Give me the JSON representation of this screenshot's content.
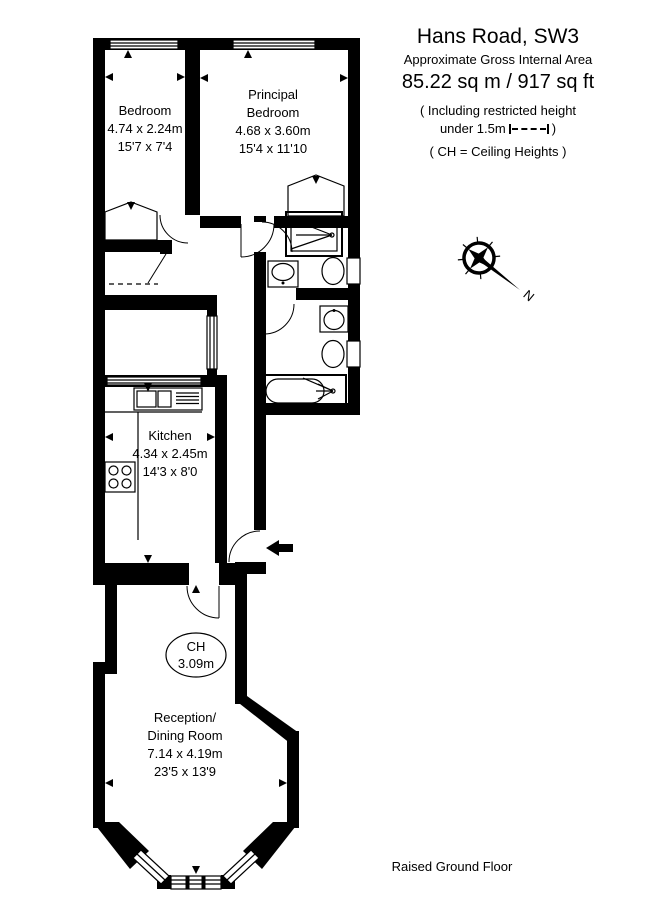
{
  "header": {
    "title": "Hans Road, SW3",
    "subtitle": "Approximate Gross Internal Area",
    "area": "85.22 sq m  /  917 sq ft",
    "note1": "( Including restricted height",
    "note2_pre": "under 1.5m",
    "note2_post": ")",
    "note3": "( CH = Ceiling Heights )"
  },
  "footer": {
    "label": "Raised Ground Floor"
  },
  "compass": {
    "north": "N"
  },
  "rooms": {
    "bedroom": {
      "name": "Bedroom",
      "metric": "4.74 x 2.24m",
      "imperial": "15'7 x 7'4"
    },
    "principal": {
      "line1": "Principal",
      "line2": "Bedroom",
      "metric": "4.68 x 3.60m",
      "imperial": "15'4 x 11'10"
    },
    "kitchen": {
      "name": "Kitchen",
      "metric": "4.34 x 2.45m",
      "imperial": "14'3 x 8'0"
    },
    "reception": {
      "line1": "Reception/",
      "line2": "Dining Room",
      "metric": "7.14 x 4.19m",
      "imperial": "23'5 x 13'9"
    },
    "ch": {
      "label": "CH",
      "value": "3.09m"
    }
  }
}
